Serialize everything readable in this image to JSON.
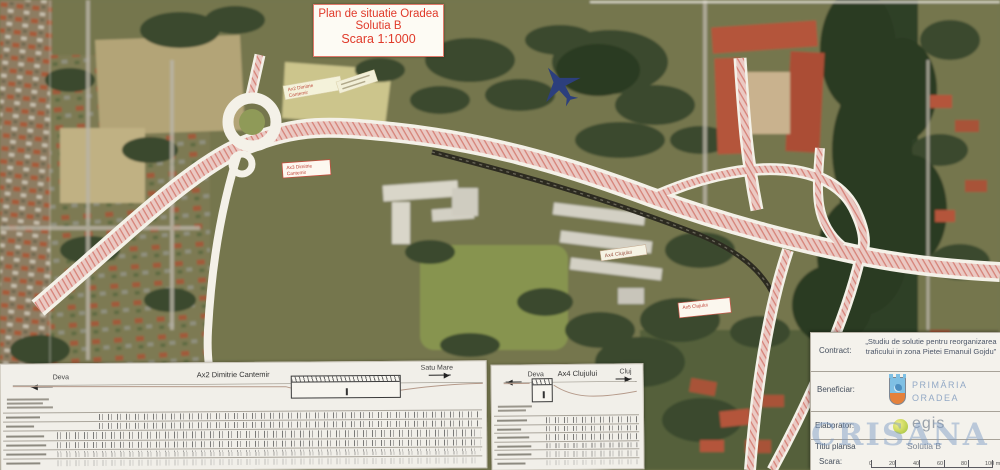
{
  "title_box": {
    "line1": "Plan de situatie Oradea",
    "line2": "Solutia B",
    "line3": "Scara 1:1000"
  },
  "map_labels": [
    {
      "line1": "Ax2 Dimitrie",
      "line2": "Cantemir"
    },
    {
      "line1": "Ax3 Dimitrie",
      "line2": "Cantemir"
    },
    {
      "line1": "Ax4 Clujului",
      "line2": ""
    },
    {
      "line1": "Ax5 Clujului",
      "line2": ""
    }
  ],
  "profiles": {
    "left": {
      "dir_left": "Deva",
      "title": "Ax2 Dimitrie Cantemir",
      "dir_right": "Satu Mare"
    },
    "right": {
      "dir_left": "Deva",
      "title": "Ax4 Clujului",
      "dir_right": "Cluj"
    }
  },
  "title_block": {
    "contract_label": "Contract:",
    "contract_value": "„Studiu de solutie pentru reorganizarea traficului in zona Pietei Emanuil Gojdu”",
    "beneficiar_label": "Beneficiar:",
    "beneficiar_line1": "PRIMĂRIA",
    "beneficiar_line2": "ORADEA",
    "elaborator_label": "Elaborator:",
    "elaborator_value": "egis",
    "titlu_label": "Titlu plansa",
    "titlu_value": "Solutia B",
    "scara_label": "Scara:",
    "scale_ticks": [
      "0",
      "20",
      "40",
      "60",
      "80",
      "100 m"
    ]
  },
  "watermark": "CRISANA",
  "colors": {
    "road_pink": "#eac9c3",
    "road_stripe": "#cf6a5e",
    "title_red": "#e03a2a",
    "watermark_blue": "#7d9bc3",
    "primaria_blue": "#93a9c6",
    "egis_green": "#9cc24e"
  }
}
